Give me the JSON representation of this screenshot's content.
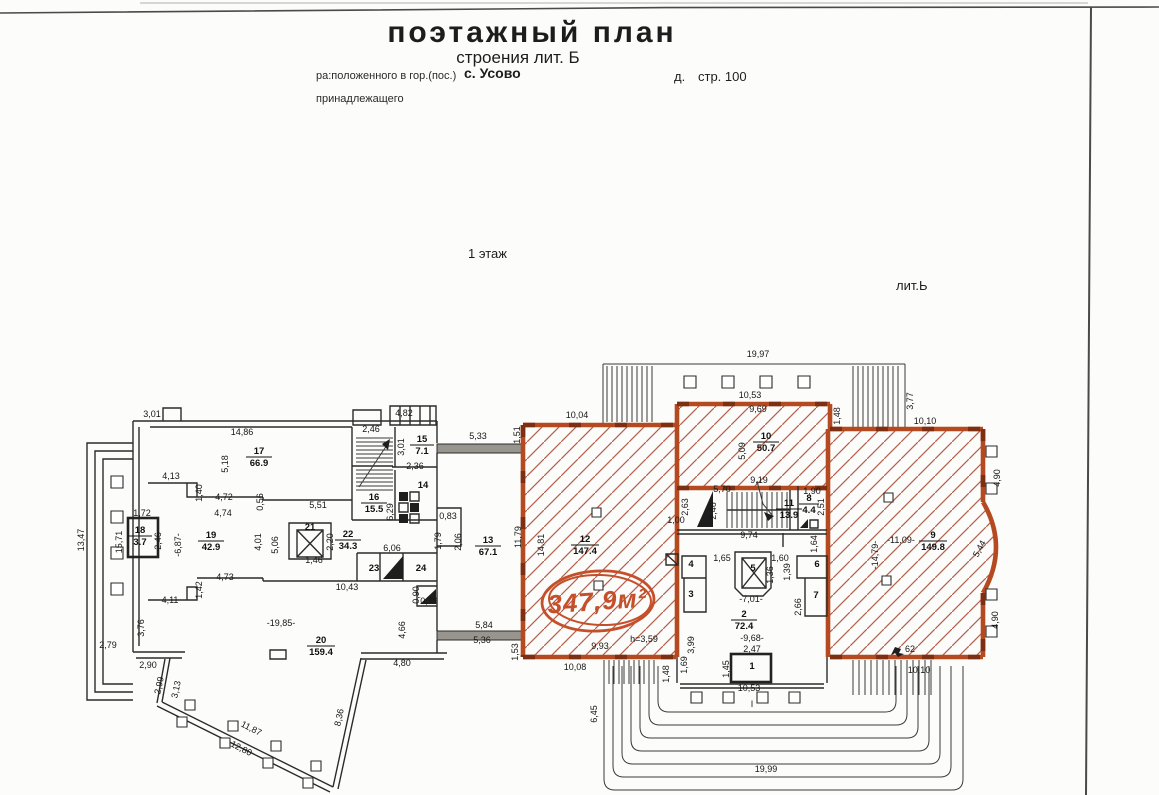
{
  "document": {
    "title": "поэтажный план",
    "subtitle": "строения лит. Б",
    "located_label": "ра:положенного в гор.(пос.)",
    "located_value": "с. Усово",
    "house_label": "д.",
    "building_label": "стр. 100",
    "belongs_label": "принадлежащего",
    "floor_label": "1 этаж",
    "lit_label": "лит.Ь"
  },
  "stamp": {
    "area_label": "347,9м²",
    "color": "#c4502b"
  },
  "notes": {
    "height": "h=3,59",
    "mark": "62",
    "section": "I"
  },
  "colors": {
    "walls_orange": "#b5491f",
    "hatch_red": "#b4604c",
    "ink": "#2b2b2b",
    "paper": "#fcfcfa"
  },
  "rooms": {
    "r1": {
      "n": "1"
    },
    "r2": {
      "n": "2",
      "a": "72.4"
    },
    "r3": {
      "n": "3"
    },
    "r4": {
      "n": "4"
    },
    "r5": {
      "n": "5"
    },
    "r6": {
      "n": "6"
    },
    "r7": {
      "n": "7"
    },
    "r8": {
      "n": "8",
      "a": "4.4"
    },
    "r9": {
      "n": "9",
      "a": "149.8"
    },
    "r10": {
      "n": "10",
      "a": "50.7"
    },
    "r11": {
      "n": "11",
      "a": "13.9"
    },
    "r12": {
      "n": "12",
      "a": "147.4"
    },
    "r13": {
      "n": "13",
      "a": "67.1"
    },
    "r14": {
      "n": "14"
    },
    "r15": {
      "n": "15",
      "a": "7.1"
    },
    "r16": {
      "n": "16",
      "a": "15.5"
    },
    "r17": {
      "n": "17",
      "a": "66.9"
    },
    "r18": {
      "n": "18",
      "a": "3.7"
    },
    "r19": {
      "n": "19",
      "a": "42.9"
    },
    "r20": {
      "n": "20",
      "a": "159.4"
    },
    "r21": {
      "n": "21"
    },
    "r22": {
      "n": "22",
      "a": "34.3"
    },
    "r23": {
      "n": "23"
    },
    "r24": {
      "n": "24"
    }
  },
  "dims": [
    "3,01",
    "14,86",
    "2,46",
    "4,82",
    "5,18",
    "4,13",
    "1,40",
    "4,72",
    "4,74",
    "0,56",
    "5,51",
    "3,01",
    "2,36",
    "6,29",
    "1,72",
    "15,71",
    "2,46",
    "-6,87-",
    "4,01",
    "5,06",
    "2,20",
    "1,46",
    "6,06",
    "0,83",
    "1,79",
    "2,06",
    "10,43",
    "0,90",
    "0,79",
    "4,73",
    "1,42",
    "4,11",
    "3,76",
    "2,79",
    "2,90",
    "-19,85-",
    "4,66",
    "4,80",
    "2,99",
    "3,13",
    "11,87",
    "12,80",
    "8,36",
    "13,47",
    "5,33",
    "1,51",
    "5,84",
    "5,36",
    "1,53",
    "11,79",
    "10,04",
    "19,97",
    "10,53",
    "9,69",
    "3,77",
    "10,10",
    "1,48",
    "5,09",
    "14,81",
    "9,19",
    "5,70",
    "2,63",
    "1,00",
    "2,46",
    "1,90",
    "2,51",
    "9,74",
    "1,64",
    "1,65",
    "1,60",
    "1,36",
    "1,39",
    "2,66",
    "-7,01-",
    "-9,68-",
    "2,47",
    "3,99",
    "1,69",
    "1,45",
    "1,48",
    "10,53",
    "-11,09-",
    "-14,79-",
    "5,44",
    "4,90",
    "4,90",
    "10,10",
    "10,08",
    "9,93",
    "6,45",
    "19,99"
  ]
}
